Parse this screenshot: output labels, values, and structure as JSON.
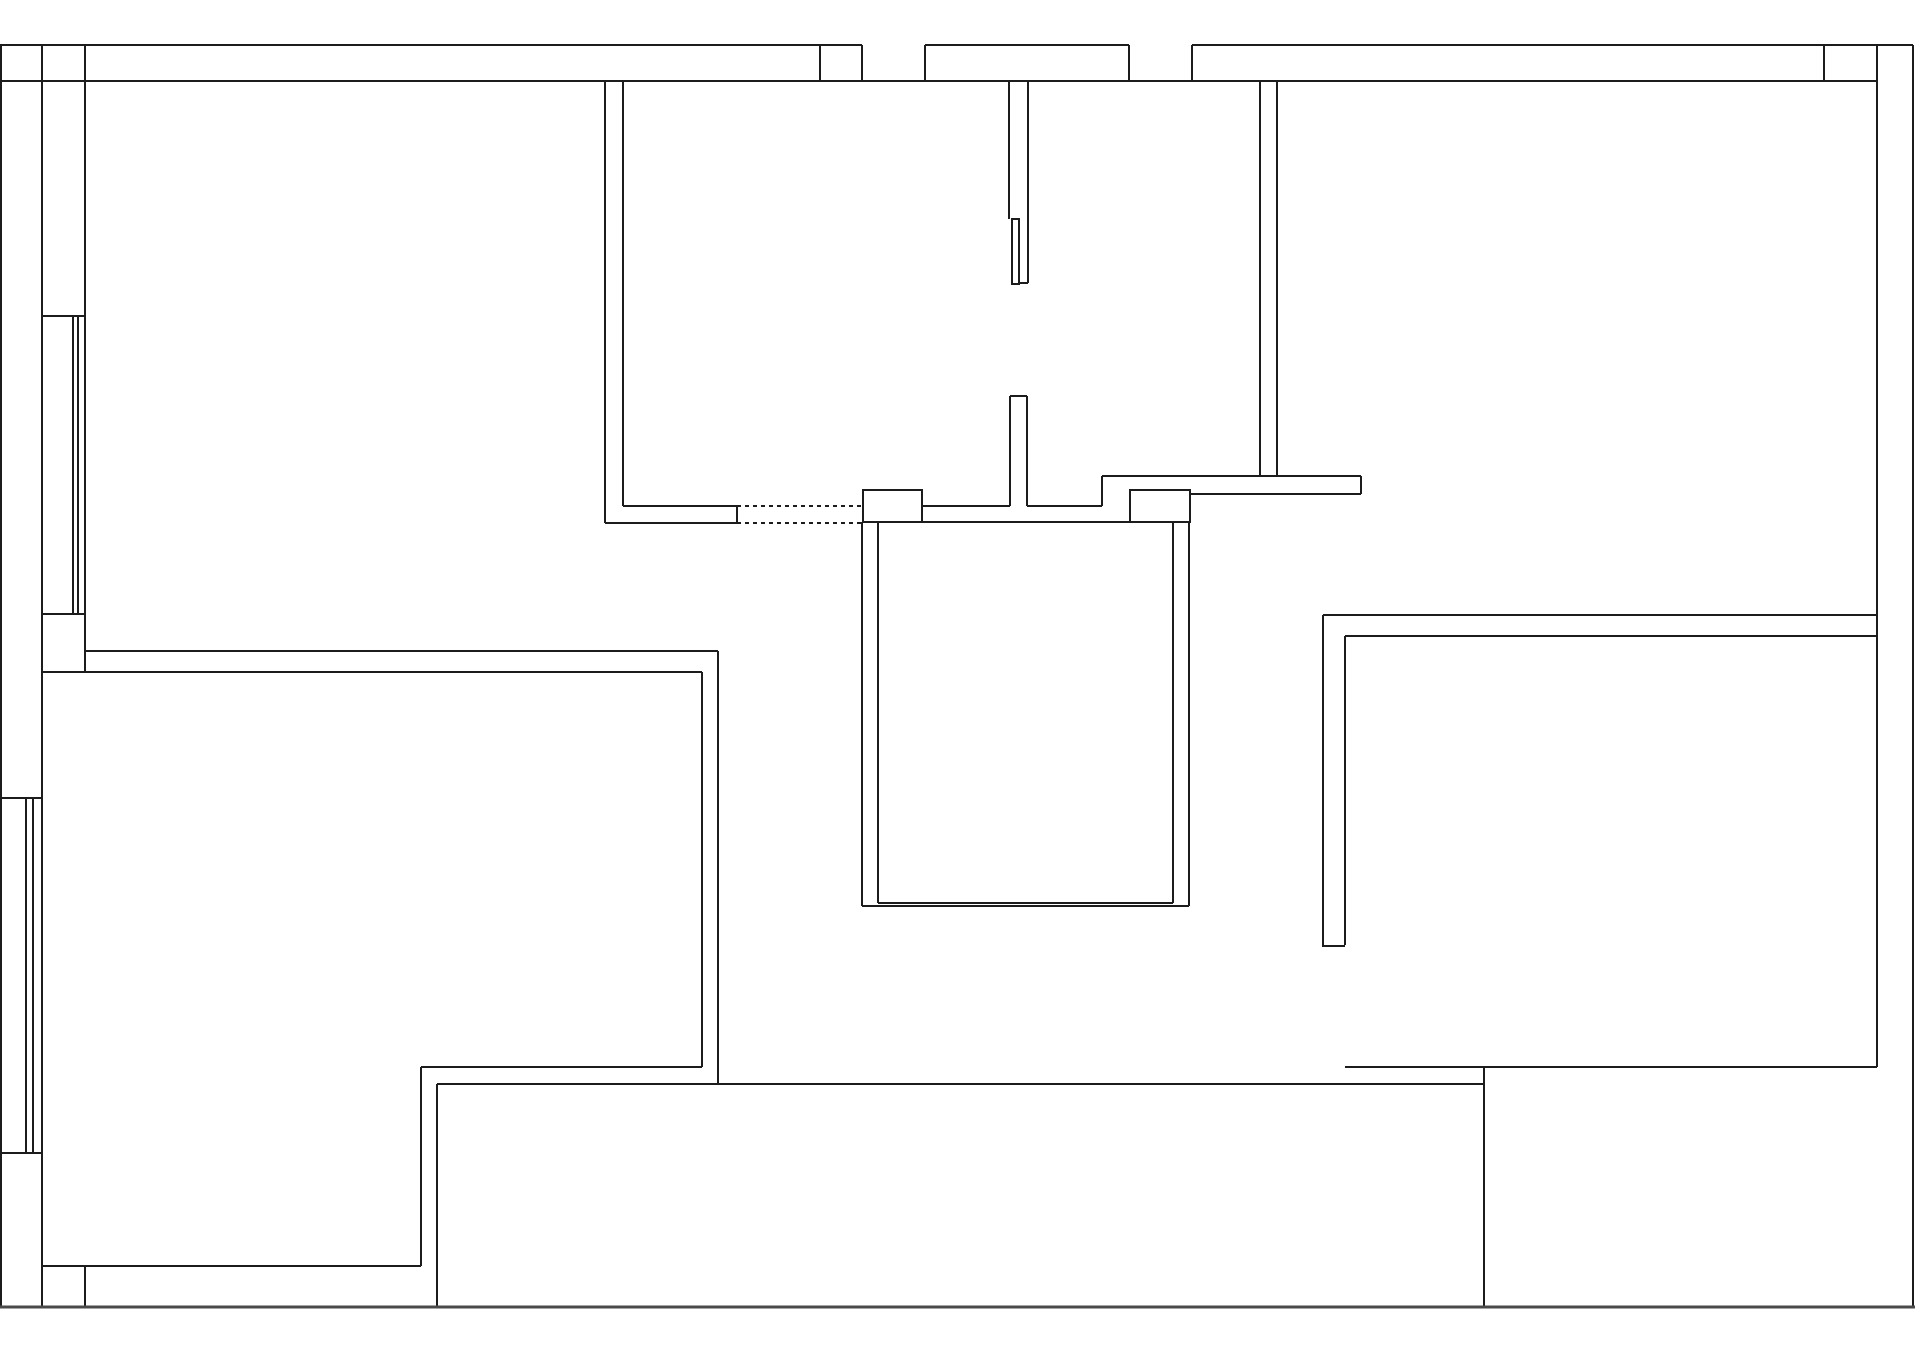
{
  "meta": {
    "document_type": "architectural-floor-plan",
    "canvas": {
      "width": 1920,
      "height": 1355
    },
    "colors": {
      "background": "#ffffff",
      "wall_line": "#1c1c1c",
      "bottom_boundary_line": "#4a4a4a"
    },
    "line_weights": {
      "standard": 2,
      "heavy": 3
    }
  },
  "floorplan": {
    "wall_segments": [
      [
        0,
        45,
        862,
        45
      ],
      [
        925,
        45,
        1129,
        45
      ],
      [
        1192,
        45,
        1913,
        45
      ],
      [
        0,
        81,
        1877,
        81
      ],
      [
        820,
        45,
        820,
        81
      ],
      [
        862,
        45,
        862,
        81
      ],
      [
        925,
        45,
        925,
        81
      ],
      [
        1129,
        45,
        1129,
        81
      ],
      [
        1192,
        45,
        1192,
        81
      ],
      [
        1824,
        45,
        1824,
        81
      ],
      [
        1,
        45,
        1,
        1307
      ],
      [
        42,
        45,
        42,
        1307
      ],
      [
        85,
        45,
        85,
        672
      ],
      [
        85,
        1266,
        85,
        1307
      ],
      [
        42,
        316,
        85,
        316
      ],
      [
        42,
        614,
        85,
        614
      ],
      [
        73,
        316,
        73,
        614
      ],
      [
        78,
        316,
        78,
        614
      ],
      [
        0,
        798,
        42,
        798
      ],
      [
        0,
        1153,
        42,
        1153
      ],
      [
        26,
        798,
        26,
        1153
      ],
      [
        33,
        798,
        33,
        1153
      ],
      [
        85,
        651,
        718,
        651
      ],
      [
        42,
        672,
        702,
        672
      ],
      [
        718,
        651,
        718,
        1084
      ],
      [
        702,
        672,
        702,
        1067
      ],
      [
        421,
        1067,
        702,
        1067
      ],
      [
        421,
        1067,
        421,
        1266
      ],
      [
        42,
        1266,
        421,
        1266
      ],
      [
        437,
        1084,
        1484,
        1084
      ],
      [
        437,
        1084,
        437,
        1307
      ],
      [
        605,
        81,
        605,
        523
      ],
      [
        623,
        81,
        623,
        506
      ],
      [
        605,
        523,
        737,
        523
      ],
      [
        623,
        506,
        737,
        506
      ],
      [
        737,
        506,
        737,
        523
      ],
      [
        922,
        506,
        1010,
        506
      ],
      [
        1027,
        506,
        1102,
        506
      ],
      [
        922,
        522,
        1130,
        522
      ],
      [
        1102,
        476,
        1102,
        506
      ],
      [
        1102,
        476,
        1361,
        476
      ],
      [
        1189,
        494,
        1361,
        494
      ],
      [
        1361,
        476,
        1361,
        494
      ],
      [
        1009,
        81,
        1009,
        219
      ],
      [
        1028,
        81,
        1028,
        283
      ],
      [
        1019,
        283,
        1028,
        283
      ],
      [
        1010,
        396,
        1010,
        506
      ],
      [
        1027,
        396,
        1027,
        506
      ],
      [
        1010,
        396,
        1027,
        396
      ],
      [
        862,
        522,
        862,
        906
      ],
      [
        878,
        522,
        878,
        903
      ],
      [
        1173,
        522,
        1173,
        903
      ],
      [
        1189,
        522,
        1189,
        906
      ],
      [
        878,
        903,
        1173,
        903
      ],
      [
        862,
        906,
        1189,
        906
      ],
      [
        1260,
        81,
        1260,
        476
      ],
      [
        1277,
        81,
        1277,
        476
      ],
      [
        1323,
        615,
        1877,
        615
      ],
      [
        1345,
        636,
        1877,
        636
      ],
      [
        1323,
        615,
        1323,
        947
      ],
      [
        1345,
        636,
        1345,
        945
      ],
      [
        1323,
        946,
        1345,
        946
      ],
      [
        1345,
        1067,
        1877,
        1067
      ],
      [
        1484,
        1067,
        1484,
        1307
      ],
      [
        1877,
        45,
        1877,
        1067
      ],
      [
        1913,
        45,
        1913,
        1307
      ]
    ],
    "heavy_segments": [
      [
        0,
        1307,
        1915,
        1307
      ]
    ],
    "dashed_opening_segments": [
      [
        737,
        506,
        863,
        506
      ],
      [
        737,
        523,
        863,
        523
      ]
    ],
    "piers": [
      {
        "x": 863,
        "y": 490,
        "w": 59,
        "h": 32
      },
      {
        "x": 1130,
        "y": 490,
        "w": 60,
        "h": 32
      }
    ],
    "door_leaf": {
      "x": 1012,
      "y": 219,
      "w": 7,
      "h": 65
    }
  }
}
